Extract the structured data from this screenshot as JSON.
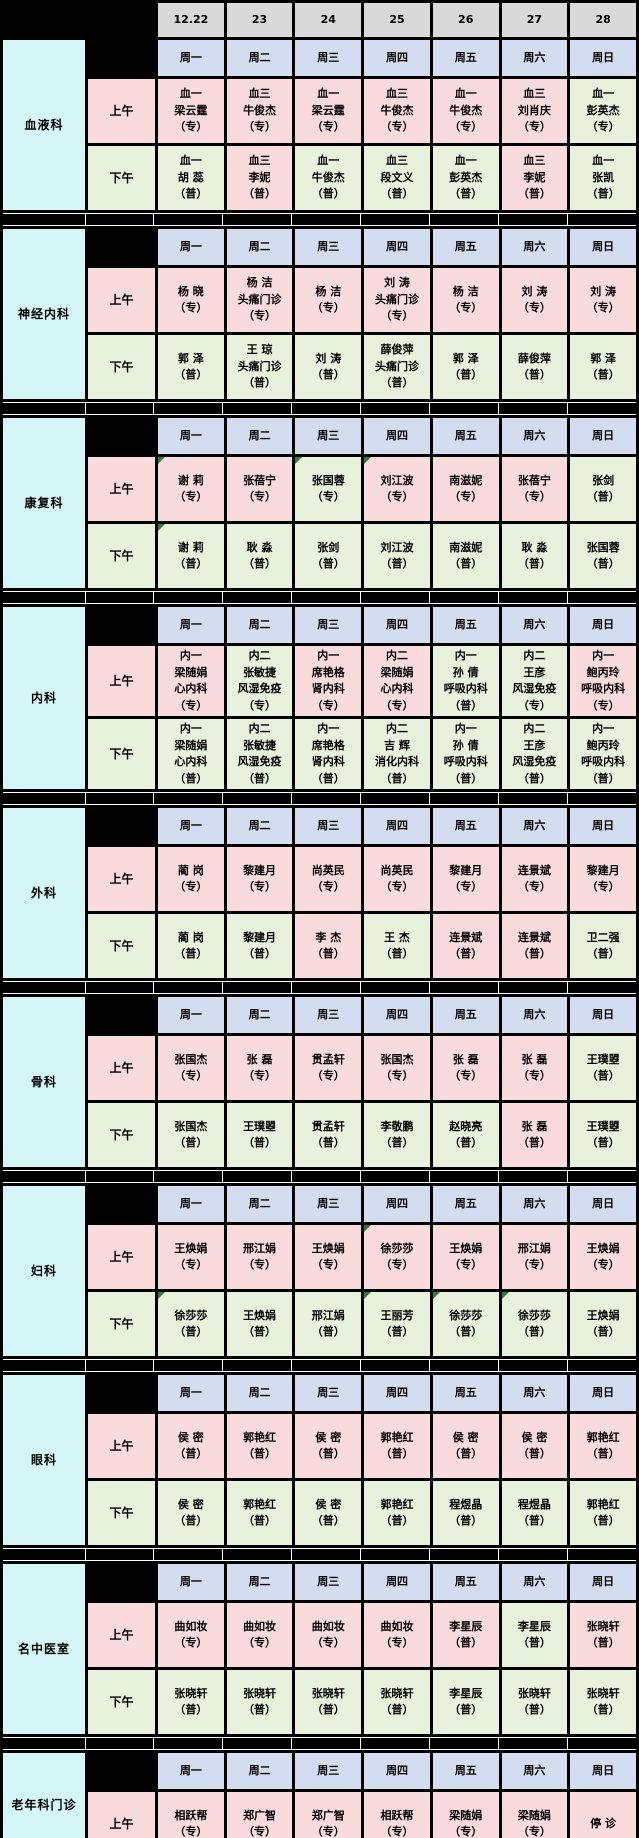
{
  "colors": {
    "pink": "#FADBDD",
    "green": "#E7F1DB",
    "gray": "#D9D9D9",
    "lavender": "#D4DCEF",
    "cyan": "#D5F6F6",
    "marker_green": "#2E7D32",
    "grid_black": "#000000"
  },
  "header": {
    "dates": [
      "12.22",
      "23",
      "24",
      "25",
      "26",
      "27",
      "28"
    ]
  },
  "weekdays": [
    "周一",
    "周二",
    "周三",
    "周四",
    "周五",
    "周六",
    "周日"
  ],
  "session_labels": {
    "morning": "上午",
    "afternoon": "下午"
  },
  "departments": [
    {
      "name": "血液科",
      "morning": [
        {
          "text": "血一\n梁云霆\n（专）",
          "bg": "pink"
        },
        {
          "text": "血三\n牛俊杰\n（专）",
          "bg": "pink"
        },
        {
          "text": "血一\n梁云霆\n（专）",
          "bg": "pink"
        },
        {
          "text": "血三\n牛俊杰\n（专）",
          "bg": "pink"
        },
        {
          "text": "血一\n牛俊杰\n（专）",
          "bg": "pink"
        },
        {
          "text": "血三\n刘肖庆\n（专）",
          "bg": "pink"
        },
        {
          "text": "血一\n彭英杰\n（专）",
          "bg": "green"
        }
      ],
      "afternoon": [
        {
          "text": "血一\n胡 蕊\n（普）",
          "bg": "green"
        },
        {
          "text": "血三\n李妮\n（普）",
          "bg": "pink"
        },
        {
          "text": "血一\n牛俊杰\n（普）",
          "bg": "green"
        },
        {
          "text": "血三\n段文义\n（普）",
          "bg": "green"
        },
        {
          "text": "血一\n彭英杰\n（普）",
          "bg": "green"
        },
        {
          "text": "血三\n李妮\n（普）",
          "bg": "pink"
        },
        {
          "text": "血一\n张凯\n（普）",
          "bg": "green"
        }
      ]
    },
    {
      "name": "神经内科",
      "morning": [
        {
          "text": "杨 晓\n（专）",
          "bg": "pink"
        },
        {
          "text": "杨 洁\n头痛门诊\n（专）",
          "bg": "pink"
        },
        {
          "text": "杨 洁\n（专）",
          "bg": "pink"
        },
        {
          "text": "刘 涛\n头痛门诊\n（专）",
          "bg": "pink"
        },
        {
          "text": "杨 洁\n（专）",
          "bg": "pink"
        },
        {
          "text": "刘 涛\n（专）",
          "bg": "pink"
        },
        {
          "text": "刘 涛\n（专）",
          "bg": "pink"
        }
      ],
      "afternoon": [
        {
          "text": "郭 泽\n（普）",
          "bg": "green"
        },
        {
          "text": "王 琼\n头痛门诊\n（普）",
          "bg": "green"
        },
        {
          "text": "刘 涛\n（普）",
          "bg": "green"
        },
        {
          "text": "薛俊萍\n头痛门诊\n（普）",
          "bg": "green"
        },
        {
          "text": "郭 泽\n（普）",
          "bg": "green"
        },
        {
          "text": "薛俊萍\n（普）",
          "bg": "green"
        },
        {
          "text": "郭 泽\n（普）",
          "bg": "green"
        }
      ]
    },
    {
      "name": "康复科",
      "morning": [
        {
          "text": "谢 莉\n（专）",
          "bg": "pink",
          "marker": true
        },
        {
          "text": "张蓓宁\n（专）",
          "bg": "pink"
        },
        {
          "text": "张国蓉\n（专）",
          "bg": "green",
          "marker": true
        },
        {
          "text": "刘江波\n（专）",
          "bg": "pink",
          "marker": true
        },
        {
          "text": "南滋妮\n（专）",
          "bg": "pink"
        },
        {
          "text": "张蓓宁\n（专）",
          "bg": "pink"
        },
        {
          "text": "张剑\n（普）",
          "bg": "green"
        }
      ],
      "afternoon": [
        {
          "text": "谢 莉\n（普）",
          "bg": "green",
          "marker": true
        },
        {
          "text": "耿 淼\n（普）",
          "bg": "green"
        },
        {
          "text": "张剑\n（普）",
          "bg": "green"
        },
        {
          "text": "刘江波\n（普）",
          "bg": "green"
        },
        {
          "text": "南滋妮\n（普）",
          "bg": "green"
        },
        {
          "text": "耿 淼\n（普）",
          "bg": "green"
        },
        {
          "text": "张国蓉\n（普）",
          "bg": "green"
        }
      ]
    },
    {
      "name": "内科",
      "morning": [
        {
          "text": "内一\n梁随娟\n心内科\n（专）",
          "bg": "pink"
        },
        {
          "text": "内二\n张敏捷\n风湿免疫\n（专）",
          "bg": "green"
        },
        {
          "text": "内一\n席艳格\n肾内科\n（专）",
          "bg": "pink"
        },
        {
          "text": "内二\n梁随娟\n心内科\n（专）",
          "bg": "pink"
        },
        {
          "text": "内一\n孙 倩\n呼吸内科\n（普）",
          "bg": "green"
        },
        {
          "text": "内二\n王彦\n风湿免疫\n（专）",
          "bg": "green"
        },
        {
          "text": "内一\n鲍丙玲\n呼吸内科\n（专）",
          "bg": "pink"
        }
      ],
      "afternoon": [
        {
          "text": "内一\n梁随娟\n心内科\n（普）",
          "bg": "green"
        },
        {
          "text": "内二\n张敏捷\n风湿免疫\n（普）",
          "bg": "green"
        },
        {
          "text": "内一\n席艳格\n肾内科\n（普）",
          "bg": "green"
        },
        {
          "text": "内二\n吉 辉\n消化内科\n（普）",
          "bg": "green"
        },
        {
          "text": "内一\n孙 倩\n呼吸内科\n（普）",
          "bg": "green"
        },
        {
          "text": "内二\n王彦\n风湿免疫\n（普）",
          "bg": "green"
        },
        {
          "text": "内一\n鲍丙玲\n呼吸内科\n（普）",
          "bg": "green"
        }
      ]
    },
    {
      "name": "外科",
      "morning": [
        {
          "text": "蔺 岗\n（专）",
          "bg": "pink"
        },
        {
          "text": "黎建月\n（专）",
          "bg": "pink"
        },
        {
          "text": "尚英民\n（专）",
          "bg": "pink"
        },
        {
          "text": "尚英民\n（专）",
          "bg": "pink"
        },
        {
          "text": "黎建月\n（专）",
          "bg": "pink"
        },
        {
          "text": "连景斌\n（专）",
          "bg": "pink"
        },
        {
          "text": "黎建月\n（专）",
          "bg": "pink"
        }
      ],
      "afternoon": [
        {
          "text": "蔺 岗\n（普）",
          "bg": "green"
        },
        {
          "text": "黎建月\n（普）",
          "bg": "green"
        },
        {
          "text": "李 杰\n（普）",
          "bg": "pink"
        },
        {
          "text": "王 杰\n（普）",
          "bg": "green"
        },
        {
          "text": "连景斌\n（普）",
          "bg": "pink"
        },
        {
          "text": "连景斌\n（普）",
          "bg": "pink"
        },
        {
          "text": "卫二强\n（普）",
          "bg": "green"
        }
      ]
    },
    {
      "name": "骨科",
      "morning": [
        {
          "text": "张国杰\n（专）",
          "bg": "pink"
        },
        {
          "text": "张 磊\n（专）",
          "bg": "pink"
        },
        {
          "text": "贯孟轩\n（专）",
          "bg": "pink"
        },
        {
          "text": "张国杰\n（专）",
          "bg": "pink"
        },
        {
          "text": "张 磊\n（专）",
          "bg": "pink"
        },
        {
          "text": "张 磊\n（专）",
          "bg": "pink"
        },
        {
          "text": "王璞曌\n（普）",
          "bg": "green"
        }
      ],
      "afternoon": [
        {
          "text": "张国杰\n（普）",
          "bg": "green"
        },
        {
          "text": "王璞曌\n（普）",
          "bg": "green"
        },
        {
          "text": "贯孟轩\n（普）",
          "bg": "green"
        },
        {
          "text": "李敬鹏\n（普）",
          "bg": "green"
        },
        {
          "text": "赵晓亮\n（普）",
          "bg": "green"
        },
        {
          "text": "张 磊\n（普）",
          "bg": "pink"
        },
        {
          "text": "王璞曌\n（普）",
          "bg": "green"
        }
      ]
    },
    {
      "name": "妇科",
      "morning": [
        {
          "text": "王焕娟\n（专）",
          "bg": "pink"
        },
        {
          "text": "邢江娟\n（专）",
          "bg": "pink"
        },
        {
          "text": "王焕娟\n（专）",
          "bg": "pink"
        },
        {
          "text": "徐莎莎\n（专）",
          "bg": "pink",
          "marker": true
        },
        {
          "text": "王焕娟\n（专）",
          "bg": "pink"
        },
        {
          "text": "邢江娟\n（专）",
          "bg": "pink"
        },
        {
          "text": "王焕娟\n（专）",
          "bg": "pink"
        }
      ],
      "afternoon": [
        {
          "text": "徐莎莎\n（普）",
          "bg": "green",
          "marker": true
        },
        {
          "text": "王焕娟\n（普）",
          "bg": "green"
        },
        {
          "text": "邢江娟\n（普）",
          "bg": "green"
        },
        {
          "text": "王丽芳\n（普）",
          "bg": "green",
          "marker": true
        },
        {
          "text": "徐莎莎\n（普）",
          "bg": "green",
          "marker": true
        },
        {
          "text": "徐莎莎\n（普）",
          "bg": "green",
          "marker": true
        },
        {
          "text": "王焕娟\n（普）",
          "bg": "green"
        }
      ]
    },
    {
      "name": "眼科",
      "morning": [
        {
          "text": "侯 密\n（普）",
          "bg": "pink"
        },
        {
          "text": "郭艳红\n（普）",
          "bg": "pink"
        },
        {
          "text": "侯 密\n（普）",
          "bg": "pink"
        },
        {
          "text": "郭艳红\n（普）",
          "bg": "pink"
        },
        {
          "text": "侯 密\n（普）",
          "bg": "pink"
        },
        {
          "text": "侯 密\n（普）",
          "bg": "pink"
        },
        {
          "text": "郭艳红\n（普）",
          "bg": "pink"
        }
      ],
      "afternoon": [
        {
          "text": "侯 密\n（普）",
          "bg": "green"
        },
        {
          "text": "郭艳红\n（普）",
          "bg": "green"
        },
        {
          "text": "侯 密\n（普）",
          "bg": "green"
        },
        {
          "text": "郭艳红\n（普）",
          "bg": "green"
        },
        {
          "text": "程煜晶\n（普）",
          "bg": "green"
        },
        {
          "text": "程煜晶\n（普）",
          "bg": "green"
        },
        {
          "text": "郭艳红\n（普）",
          "bg": "green"
        }
      ]
    },
    {
      "name": "名中医室",
      "morning": [
        {
          "text": "曲如妆\n（专）",
          "bg": "pink"
        },
        {
          "text": "曲如妆\n（专）",
          "bg": "pink"
        },
        {
          "text": "曲如妆\n（专）",
          "bg": "pink"
        },
        {
          "text": "曲如妆\n（专）",
          "bg": "pink"
        },
        {
          "text": "李星辰\n（普）",
          "bg": "pink"
        },
        {
          "text": "李星辰\n（普）",
          "bg": "green"
        },
        {
          "text": "张晓轩\n（普）",
          "bg": "pink"
        }
      ],
      "afternoon": [
        {
          "text": "张晓轩\n（普）",
          "bg": "green"
        },
        {
          "text": "张晓轩\n（普）",
          "bg": "green"
        },
        {
          "text": "张晓轩\n（普）",
          "bg": "green"
        },
        {
          "text": "张晓轩\n（普）",
          "bg": "green"
        },
        {
          "text": "李星辰\n（普）",
          "bg": "green"
        },
        {
          "text": "张晓轩\n（普）",
          "bg": "green"
        },
        {
          "text": "张晓轩\n（普）",
          "bg": "green"
        }
      ]
    },
    {
      "name": "老年科门诊",
      "morning": [
        {
          "text": "相跃帮\n（专）",
          "bg": "pink"
        },
        {
          "text": "郑广智\n（专）",
          "bg": "pink"
        },
        {
          "text": "郑广智\n（专）",
          "bg": "pink"
        },
        {
          "text": "相跃帮\n（专）",
          "bg": "pink"
        },
        {
          "text": "梁随娟\n（专）",
          "bg": "pink"
        },
        {
          "text": "梁随娟\n（专）",
          "bg": "pink"
        },
        {
          "text": "停 诊",
          "bg": "pink"
        }
      ],
      "afternoon": null
    }
  ]
}
